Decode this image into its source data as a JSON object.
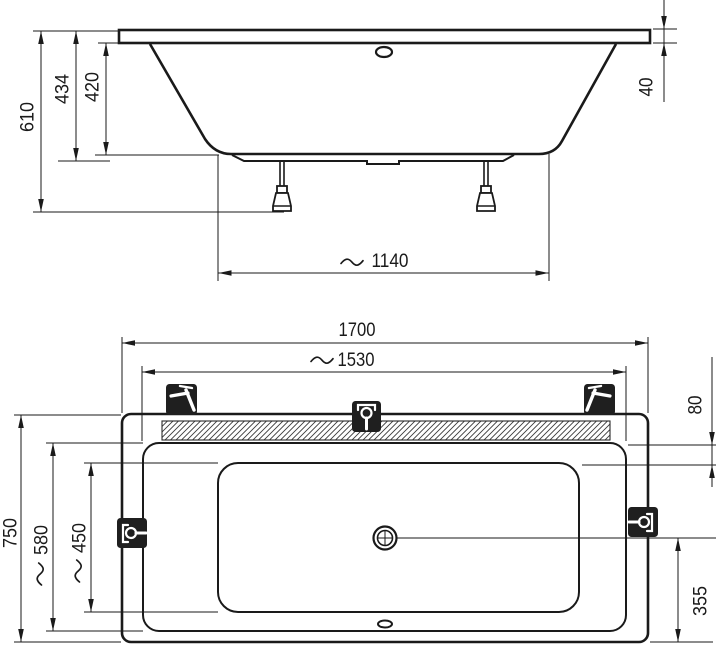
{
  "drawing": {
    "subject": "rectangular bathtub with support frame - dimension drawing",
    "views": [
      "side elevation",
      "plan view"
    ],
    "units": "mm",
    "colors": {
      "ink": "#1a1a1a",
      "background": "#ffffff",
      "fixture_fill": "#1f1f1f"
    },
    "side_view": {
      "dims": {
        "total_height": {
          "value": "610",
          "display": "610",
          "approx": false
        },
        "shell_height": {
          "value": "434",
          "display": "434",
          "approx": false
        },
        "depth": {
          "value": "420",
          "display": "420",
          "approx": false
        },
        "rim_thickness": {
          "value": "40",
          "display": "40",
          "approx": false
        },
        "base_length": {
          "value": "1140",
          "display": "~1140",
          "approx": true
        }
      }
    },
    "plan_view": {
      "dims": {
        "overall_length": {
          "value": "1700",
          "display": "1700",
          "approx": false
        },
        "rim_opening_length": {
          "value": "1530",
          "display": "~1530",
          "approx": true
        },
        "headrest_depth": {
          "value": "80",
          "display": "80",
          "approx": false
        },
        "overall_width": {
          "value": "750",
          "display": "750",
          "approx": false
        },
        "rim_opening_width": {
          "value": "580",
          "display": "~580",
          "approx": true
        },
        "bottom_width": {
          "value": "450",
          "display": "~450",
          "approx": true
        },
        "drain_offset": {
          "value": "355",
          "display": "355",
          "approx": false
        }
      },
      "fixtures": [
        "faucet-position-top-left",
        "mixer-position-top-center",
        "faucet-position-top-right",
        "mixer-position-left",
        "mixer-position-right"
      ]
    }
  }
}
